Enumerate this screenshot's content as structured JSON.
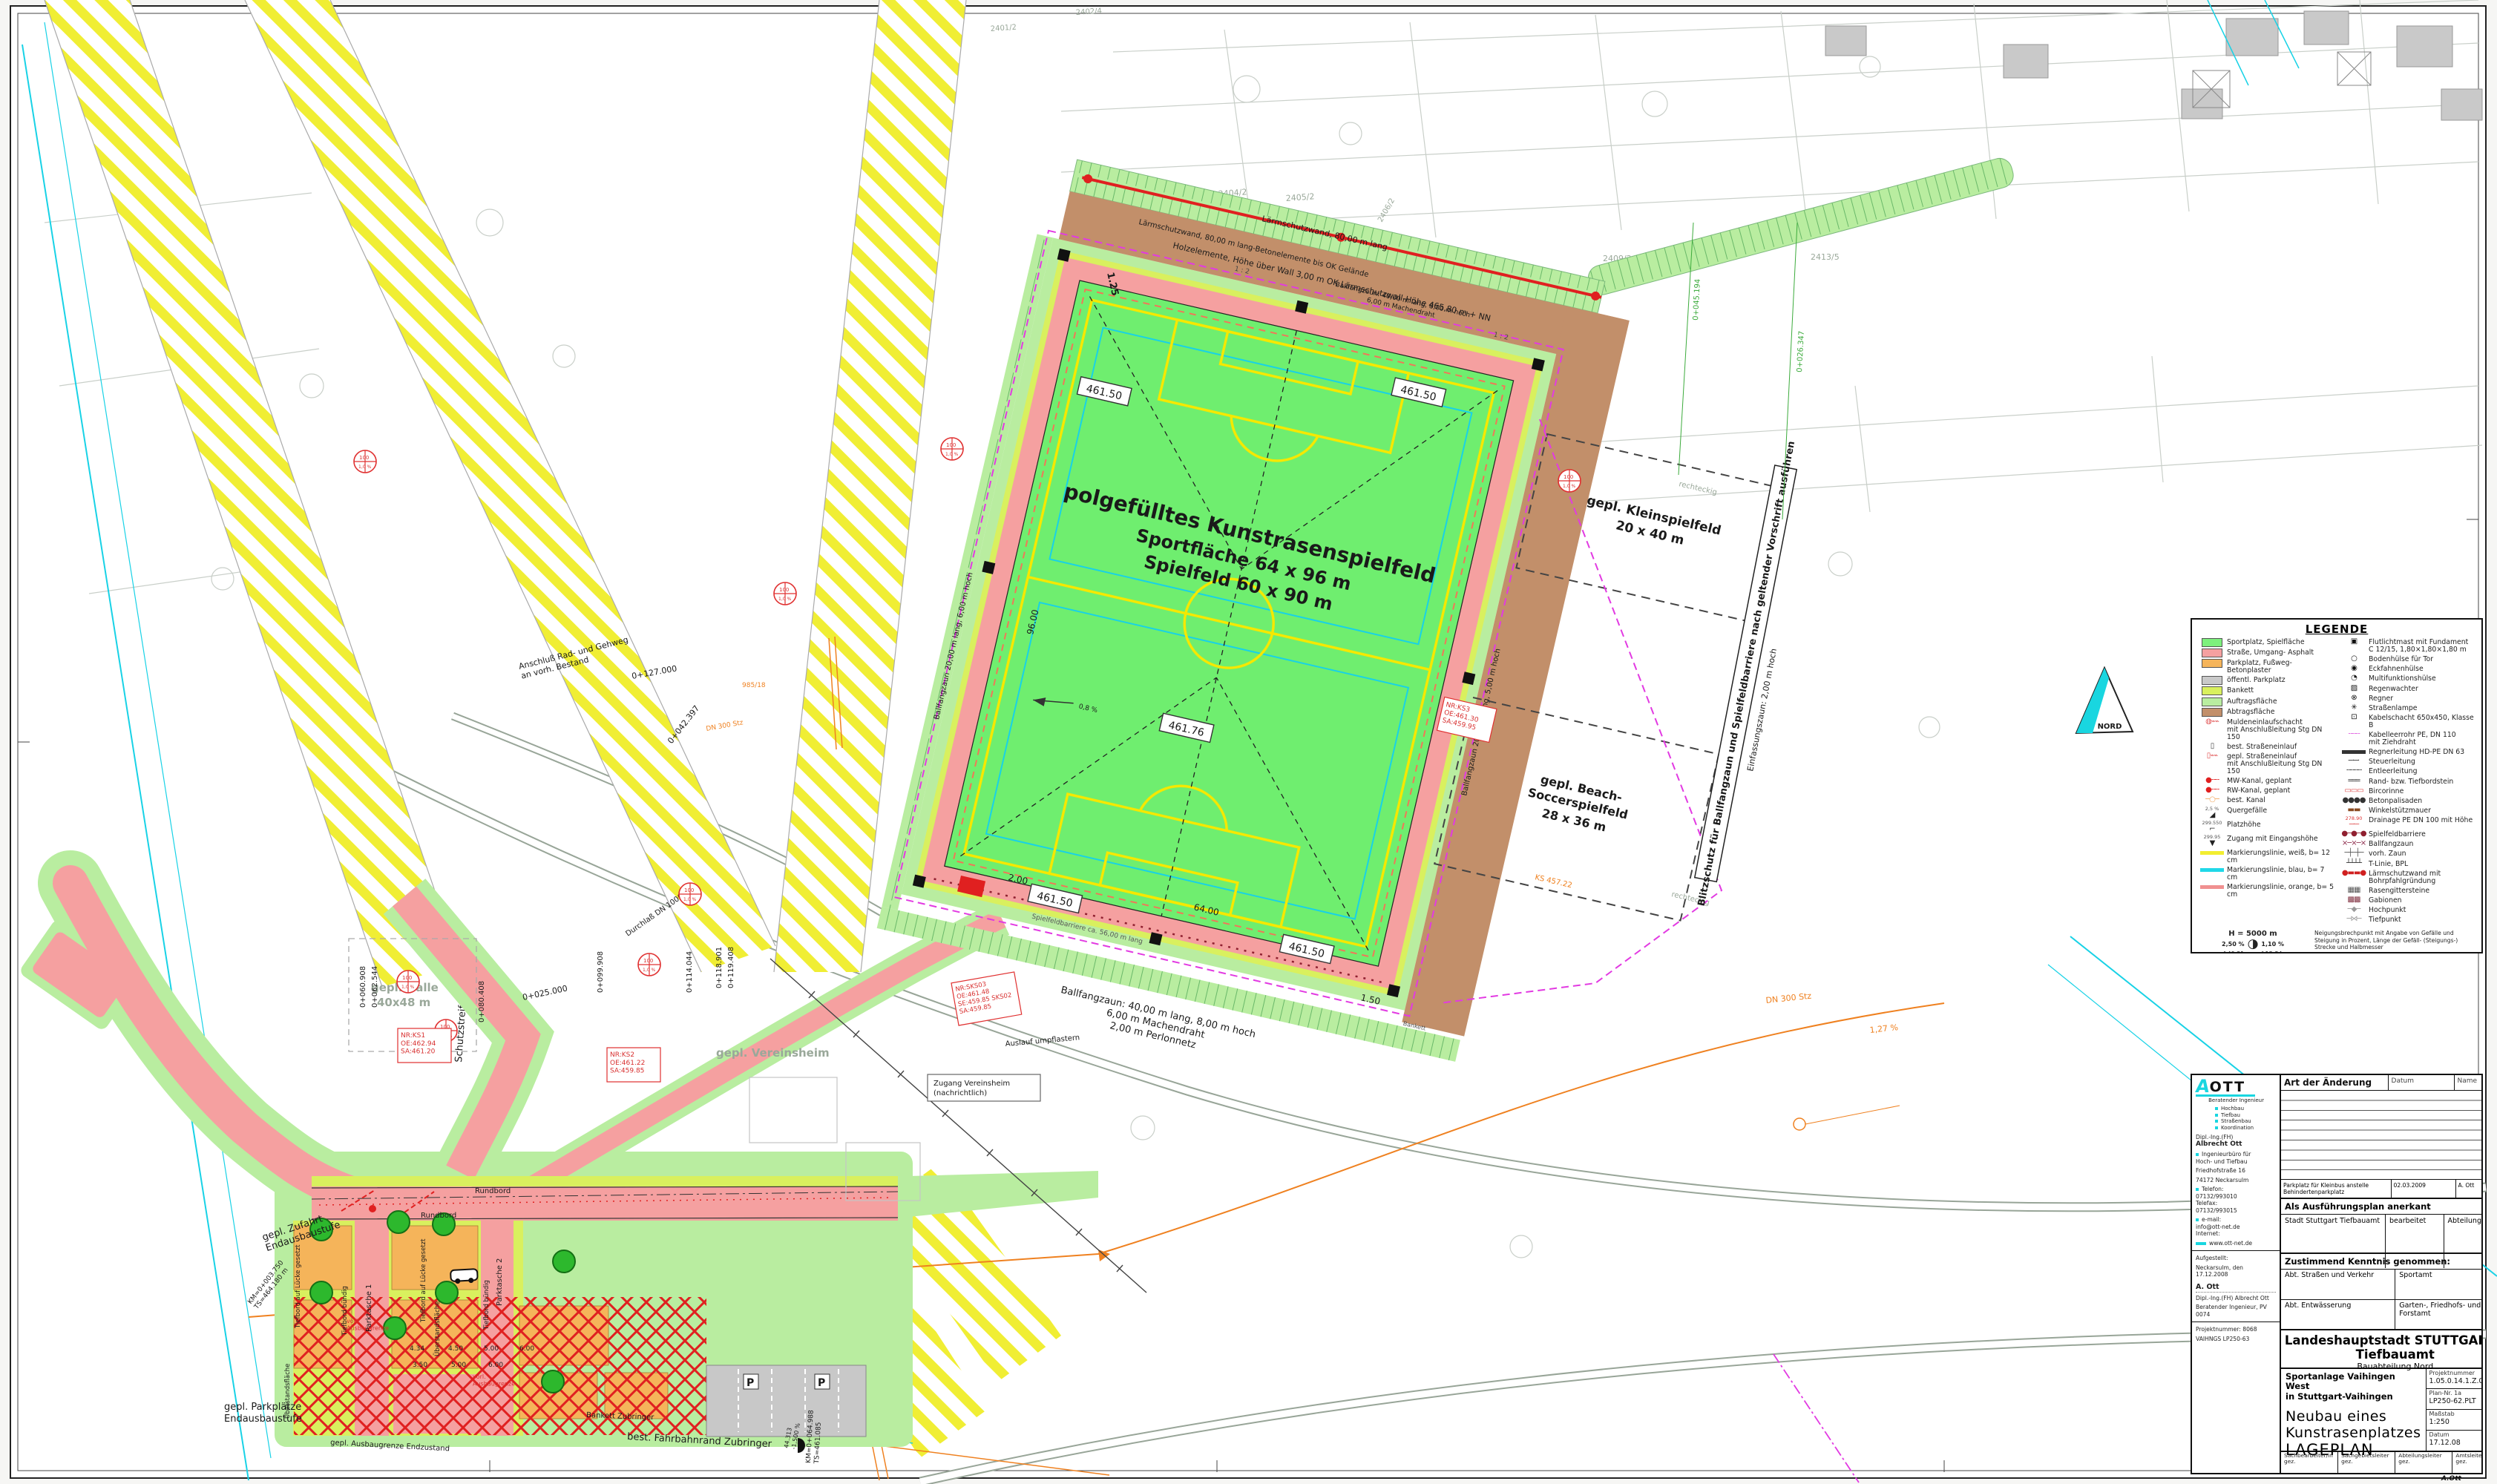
{
  "plan": {
    "field": {
      "line1": "polgefülltes Kunstrasenspielfeld",
      "line2": "Sportfläche 64 x 96 m",
      "line3": "Spielfeld 60 x 90 m",
      "grade": "0,8 %",
      "slope1": "1 : 2",
      "slope2": "1 : 2"
    },
    "elev": {
      "e1": "461.50",
      "e2": "461.50",
      "e3": "461.76",
      "e4": "461.50",
      "e5": "461.50"
    },
    "fences": {
      "bfz40a": "Ballfangzaun: 40,00 m lang, 8,00 m  hoch",
      "bfz40b": "6,00 m Machendraht",
      "bfz40c": "2,00 m Perlonnetz",
      "bfz20a": "Ballfangzaun  20,00 m lang, 6,00 m hoch",
      "bfz20b": "Ballfangzaun  20,00 m lang, 5,00 m hoch",
      "barriere": "Spielfeldbarriere ca. 56,00 m lang",
      "einf": "Einfassungszaun: 2,00 m hoch",
      "blitz": "Blitzschutz für Ballfangzaun und Spielfeldbarriere nach geltender Vorschrift ausführen"
    },
    "wall": {
      "w1": "Lärmschutzwand, 80,00 m lang",
      "w2": "Holzelemente, Höhe über Wall 3,00 m   OK Lärmschutzwall-Höhe 465,80 m + NN",
      "w3": "Lärmschutzwand, 80,00 m lang-Betonelemente bis OK Gelände"
    },
    "klein": {
      "l1": "gepl. Kleinspielfeld",
      "l2": "20 x 40 m",
      "note1": "rechteckig",
      "note2": "rechteckig"
    },
    "beach": {
      "l1": "gepl. Beach-",
      "l2": "Soccerspielfeld",
      "l3": "28 x 36 m",
      "ks": "KS 457.22"
    },
    "areas": {
      "halle1": "gepl. Halle",
      "halle2": "40x48 m",
      "verein": "gepl. Vereinsheim",
      "zug1": "Zugang Vereinsheim",
      "zug2": "(nachrichtlich)",
      "schutz": "Schutzstreifen",
      "zuf1": "gepl. Zufahrt",
      "zuf2": "Endausbaustufe",
      "pp1": "gepl. Parkplätze",
      "pp2": "Endausbaustufe",
      "grenze": "gepl. Ausbaugrenze Endzustand",
      "vorl1": "vorl.\nAusbaugrenze",
      "vorl2": "vorl.\nAusbaugrenze"
    },
    "street": {
      "rundbord1": "Rundbord",
      "rundbord2": "Rundbord",
      "bankett": "Bankett Zubringer",
      "fahrbahn": "best. Fahrbahnrand Zubringer",
      "p1": "Parktasche 1",
      "p2": "Parktasche 2",
      "tb1": "Tiefbord auf Lücke gesetzt",
      "tb2": "Tiefbord auf Lücke gesetzt",
      "tbb1": "Tiefbord bündig",
      "tbb2": "Tiefbord bündig",
      "ue1": "Überstandsfläche",
      "ue2": "Überstandsfläche",
      "bankett2": "Bankett",
      "psym1": "P",
      "psym2": "P"
    },
    "misc": {
      "anschluss": "Anschluß Rad- und Gehweg\nan vorh. Bestand",
      "durchlass": "Durchlaß DN 1000",
      "auslauf": "Auslauf umpflastern",
      "dn300a": "DN 300 Stz",
      "dn300b": "DN 300 Stz",
      "pct": "1,27 %",
      "nord": "NORD",
      "m443": "44.313",
      "pct2": "-1,500 %"
    },
    "dims": {
      "d96": "96.00",
      "d64": "64.00",
      "d200": "2.00",
      "d150": "1.50",
      "d125": "1.25"
    },
    "parkdims": [
      "4.34",
      "4.50",
      "5.00",
      "6.00",
      "3.50",
      "5.00",
      "6.00"
    ],
    "stations": {
      "s25": "0+025.000",
      "s60": "0+060.908",
      "s62": "0+062.544",
      "s80": "0+080.408",
      "s99": "0+099.908",
      "s114": "0+114.044",
      "s118": "0+118.901",
      "s119": "0+119.408",
      "s127": "0+127.000",
      "s42": "0+042.397",
      "s45": "0+045.194",
      "s26": "0+026.347",
      "km1a": "KM=0+003.750",
      "km1b": "TS=464.180 m",
      "km2a": "KM=0+064.988",
      "km2b": "TS=461.085"
    },
    "parcels": [
      "2401/2",
      "2402/4",
      "2404/2",
      "2405/2",
      "2406/2",
      "2409/2",
      "2413/5",
      "2399",
      "985/18"
    ],
    "shafts": {
      "ks1": "NR:KS1\nOE:462.94\nSA:461.20",
      "ks2": "NR:KS2\nOE:461.22\nSA:459.85",
      "sks": "NR:SKS03\nOE:461.48\nSE:459.85 SKS02\nSA:459.85",
      "ks3": "NR:KS3\nOE:461.30\nSA:459.95"
    },
    "stamp": {
      "t": "100",
      "b": "1,0 %"
    }
  },
  "legend": {
    "title": "LEGENDE",
    "left_items": [
      {
        "label": "Sportplatz, Spielfläche",
        "type": "swatch",
        "color": "#7df07d"
      },
      {
        "label": "Straße, Umgang- Asphalt",
        "type": "swatch",
        "color": "#f5a0a0"
      },
      {
        "label": "Parkplatz, Fußweg- Betonplaster",
        "type": "swatch",
        "color": "#f5b45a"
      },
      {
        "label": "öffentl. Parkplatz",
        "type": "swatch",
        "color": "#c9c9c9"
      },
      {
        "label": "Bankett",
        "type": "swatch",
        "color": "#d9f05e"
      },
      {
        "label": "Auftragsfläche",
        "type": "swatch",
        "color": "#b9eda0"
      },
      {
        "label": "Abtragsfläche",
        "type": "swatch",
        "color": "#c28f6a"
      },
      {
        "label": "Muldeneinlaufschacht\nmit Anschlußleitung Stg DN 150",
        "type": "glyph",
        "glyph": "◍⌁⌁",
        "color": "#e05050"
      },
      {
        "label": "best. Straßeneinlauf",
        "type": "glyph",
        "glyph": "▯",
        "color": "#444444"
      },
      {
        "label": "gepl. Straßeneinlauf\nmit Anschlußleitung Stg DN 150",
        "type": "glyph",
        "glyph": "▯⌁⌁",
        "color": "#e05050"
      },
      {
        "label": "MW-Kanal, geplant",
        "type": "glyph",
        "glyph": "●╌╌",
        "color": "#e02020"
      },
      {
        "label": "RW-Kanal, geplant",
        "type": "glyph",
        "glyph": "●╌╌",
        "color": "#e02020"
      },
      {
        "label": "best. Kanal",
        "type": "glyph",
        "glyph": "─○─",
        "color": "#f0a860"
      },
      {
        "label": "Quergefälle",
        "type": "glyph",
        "glyph": "◢",
        "color": "#222222",
        "note": "2,5 %"
      },
      {
        "label": "Platzhöhe",
        "type": "glyph",
        "glyph": "⌐",
        "color": "#222222",
        "note": "299.550"
      },
      {
        "label": "Zugang mit Eingangshöhe",
        "type": "glyph",
        "glyph": "▼",
        "color": "#222222",
        "note": "299.95"
      },
      {
        "label": "Markierungslinie, weiß, b= 12 cm",
        "type": "line",
        "color": "#f2ee30"
      },
      {
        "label": "Markierungslinie, blau, b= 7 cm",
        "type": "line",
        "color": "#20d8e8"
      },
      {
        "label": "Markierungslinie, orange, b= 5 cm",
        "type": "line",
        "color": "#f09090"
      }
    ],
    "right_items": [
      {
        "label": "Flutlichtmast mit Fundament\nC 12/15, 1,80×1,80×1,80 m",
        "type": "glyph",
        "glyph": "▣",
        "color": "#111111"
      },
      {
        "label": "Bodenhülse für Tor",
        "type": "glyph",
        "glyph": "○",
        "color": "#111111"
      },
      {
        "label": "Eckfahnenhülse",
        "type": "glyph",
        "glyph": "◉",
        "color": "#111111"
      },
      {
        "label": "Multifunktionshülse",
        "type": "glyph",
        "glyph": "◔",
        "color": "#111111"
      },
      {
        "label": "Regenwachter",
        "type": "glyph",
        "glyph": "▨",
        "color": "#111111"
      },
      {
        "label": "Regner",
        "type": "glyph",
        "glyph": "⊗",
        "color": "#111111"
      },
      {
        "label": "Straßenlampe",
        "type": "glyph",
        "glyph": "✳",
        "color": "#111111"
      },
      {
        "label": "Kabelschacht 650x450, Klasse B",
        "type": "glyph",
        "glyph": "⊡",
        "color": "#111111"
      },
      {
        "label": "Kabelleerrohr PE, DN 110\nmit Ziehdraht",
        "type": "glyph",
        "glyph": "╌╌╌",
        "color": "#e060e0"
      },
      {
        "label": "Regnerleitung HD-PE DN 63",
        "type": "line",
        "color": "#333333"
      },
      {
        "label": "Steuerleitung",
        "type": "glyph",
        "glyph": "─·─·",
        "color": "#333333"
      },
      {
        "label": "Entleerleitung",
        "type": "glyph",
        "glyph": "╌╌╌╌",
        "color": "#333333"
      },
      {
        "label": "Rand- bzw. Tiefbordstein",
        "type": "glyph",
        "glyph": "═══",
        "color": "#333333"
      },
      {
        "label": "Bircorinne",
        "type": "glyph",
        "glyph": "▭▭▭",
        "color": "#e05050"
      },
      {
        "label": "Betonpalisaden",
        "type": "glyph",
        "glyph": "●●●●",
        "color": "#333333"
      },
      {
        "label": "Winkelstützmauer",
        "type": "glyph",
        "glyph": "▬▬",
        "color": "#8a4a20"
      },
      {
        "label": "Drainage PE DN 100 mit Höhe",
        "type": "glyph",
        "glyph": "─·─",
        "color": "#e05050",
        "note": "278.90",
        "note_red": true
      },
      {
        "label": "Spielfeldbarriere",
        "type": "glyph",
        "glyph": "●─●─●",
        "color": "#902030"
      },
      {
        "label": "Ballfangzaun",
        "type": "glyph",
        "glyph": "⨯─⨯─⨯",
        "color": "#903050"
      },
      {
        "label": "vorh. Zaun",
        "type": "glyph",
        "glyph": "─┼─┼─",
        "color": "#555555"
      },
      {
        "label": "T-Linie, BPL",
        "type": "glyph",
        "glyph": "┴┴┴┴",
        "color": "#333333"
      },
      {
        "label": "Lärmschutzwand mit Bohrpfahlgründung",
        "type": "glyph",
        "glyph": "●▬▬●",
        "color": "#d02020"
      },
      {
        "label": "Rasengittersteine",
        "type": "glyph",
        "glyph": "▦▦",
        "color": "#555555"
      },
      {
        "label": "Gabionen",
        "type": "glyph",
        "glyph": "▩▩",
        "color": "#803040"
      },
      {
        "label": "Hochpunkt",
        "type": "glyph",
        "glyph": "─◆─",
        "color": "#999999"
      },
      {
        "label": "Tiefpunkt",
        "type": "glyph",
        "glyph": "─⋈─",
        "color": "#999999"
      }
    ],
    "scale_note": {
      "h": "H = 5000 m",
      "glyph": "◑",
      "left_pct": "2,50 %",
      "left_len": "auf 49,21 m",
      "right_pct": "1,10 %",
      "right_len": "auf 12,34 m",
      "desc": "Neigungsbrechpunkt mit Angabe von Gefälle und Steigung in Prozent, Länge der Gefäll- (Steigungs-) Strecke und Halbmesser"
    }
  },
  "titleblock": {
    "firm": {
      "logo_a": "A",
      "logo_ott": "OTT",
      "tagline": "Beratender Ingenieur",
      "services": [
        "Hochbau",
        "Tiefbau",
        "Straßenbau",
        "Koordination"
      ],
      "grad": "Dipl.-Ing.(FH)",
      "name": "Albrecht Ott",
      "office": "Ingenieurbüro für\nHoch- und Tiefbau",
      "street": "Friedhofstraße 16",
      "city": "74172 Neckarsulm",
      "tel": "Telefon:\n07132/993010\nTelefax:\n07132/993015",
      "mail": "e-mail:\ninfo@ott-net.de\nInternet:",
      "web": "www.ott-net.de",
      "created": "Aufgestellt:",
      "created2": "Neckarsulm, den 17.12.2008",
      "sig": "A. Ott",
      "sig2": "Dipl.-Ing.(FH) Albrecht Ott",
      "sig3": "Beratender Ingenieur, PV 0074",
      "proj": "Projektnummer: 8068",
      "proj2": "VAIHNGS LP250-63"
    },
    "revisions": {
      "header": "Art der Änderung",
      "datum": "Datum",
      "name": "Name",
      "entry": "Parkplatz für Kleinbus anstelle Behindertenparkplatz",
      "entry_date": "02.03.2009",
      "entry_name": "A. Ott"
    },
    "approval": {
      "title": "Als Ausführungsplan anerkant",
      "a": "Stadt Stuttgart Tiefbauamt",
      "b": "bearbeitet",
      "c": "Abteilungsleiter"
    },
    "consent": {
      "title": "Zustimmend Kenntnis genommen:",
      "r1a": "Abt. Straßen und Verkehr",
      "r1b": "Sportamt",
      "r2a": "Abt. Entwässerung",
      "r2b": "Garten-, Friedhofs- und Forstamt"
    },
    "main": {
      "city": "Landeshauptstadt STUTTGART – Tiefbauamt",
      "dept": "Bauabteilung Nord",
      "project": "Sportanlage Vaihingen West\nin Stuttgart-Vaihingen",
      "title": "Neubau eines Kunstrasenplatzes",
      "plantype": "LAGEPLAN",
      "pn_label": "Projektnummer",
      "pn": "1.05.0.14.1.Z.001.0",
      "plannr_label": "Plan-Nr. 1a",
      "plannr": "LP250-62.PLT",
      "scale_label": "Maßstab",
      "scale": "1:250",
      "date_label": "Datum",
      "date": "17.12.08",
      "sb": "Sachbearbeiter/in\ngez.",
      "sg": "Sachgebietsleiter\ngez.",
      "al": "Abteilungsleiter\ngez.",
      "amt": "Amtsleiter\ngez.",
      "stamp": "A.Ott"
    }
  }
}
